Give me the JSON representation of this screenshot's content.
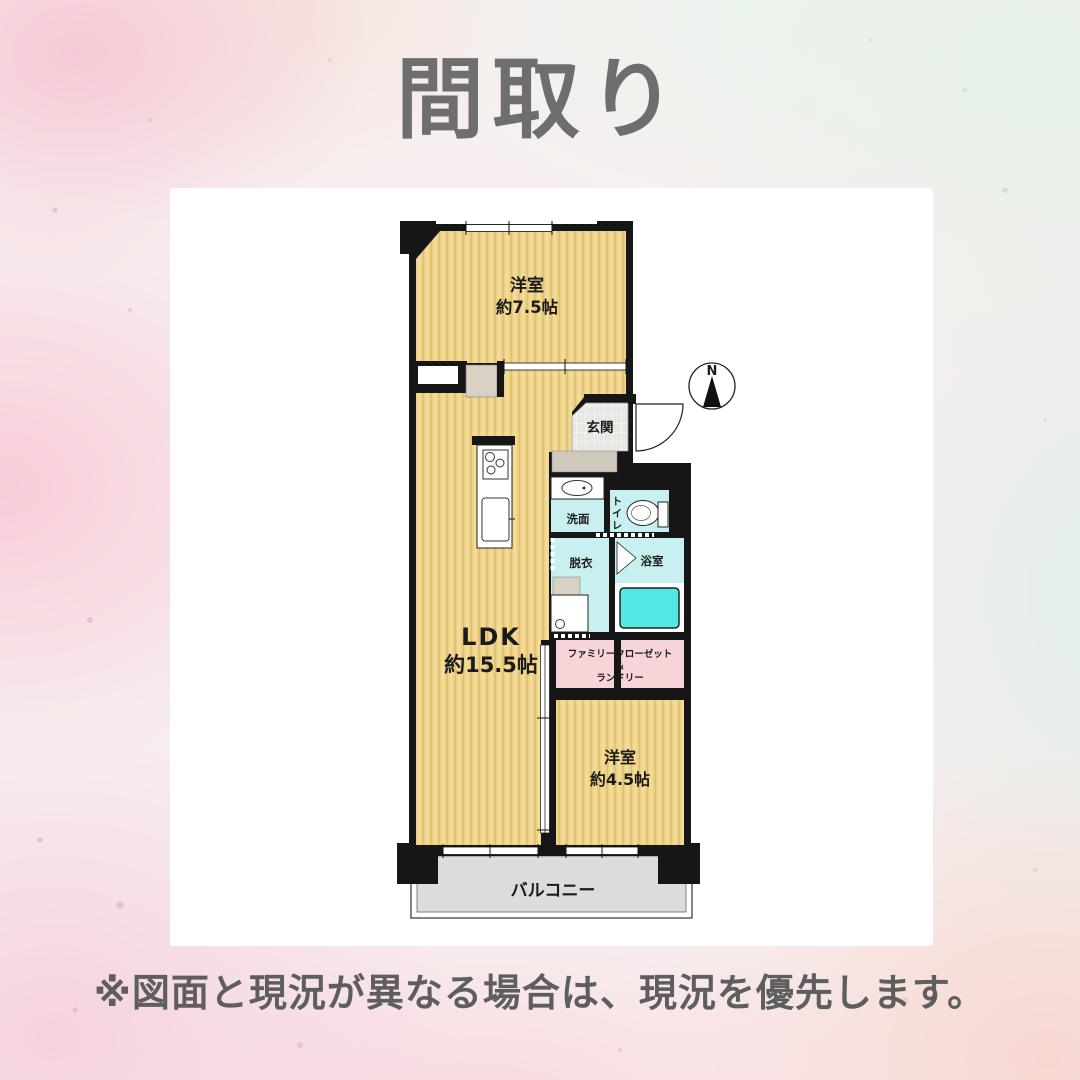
{
  "title": "間取り",
  "footer": "※図面と現況が異なる場合は、現況を優先します。",
  "compass": {
    "north_label": "N"
  },
  "rooms": {
    "bedroom1": {
      "name": "洋室",
      "size": "約7.5帖"
    },
    "ldk": {
      "name": "LDK",
      "size": "約15.5帖"
    },
    "entrance": {
      "name": "玄関"
    },
    "washroom": {
      "name": "洗面"
    },
    "toilet": {
      "name": "トイレ",
      "chars": [
        "ト",
        "イ",
        "レ"
      ]
    },
    "dressing": {
      "name": "脱衣"
    },
    "bath": {
      "name": "浴室"
    },
    "closet": {
      "line1": "ファミリークローゼット",
      "line2": "＆",
      "line3": "ランドリー"
    },
    "bedroom2": {
      "name": "洋室",
      "size": "約4.5帖"
    },
    "balcony": {
      "name": "バルコニー"
    }
  },
  "colors": {
    "room_yellow": "#edd083",
    "wet_area_cyan": "#c8f0f1",
    "bathtub_cyan": "#54e8e4",
    "closet_pink": "#f7d4d7",
    "balcony_gray": "#dcdcdc",
    "wall_black": "#161616",
    "title_gray": "#6e6e6e"
  }
}
